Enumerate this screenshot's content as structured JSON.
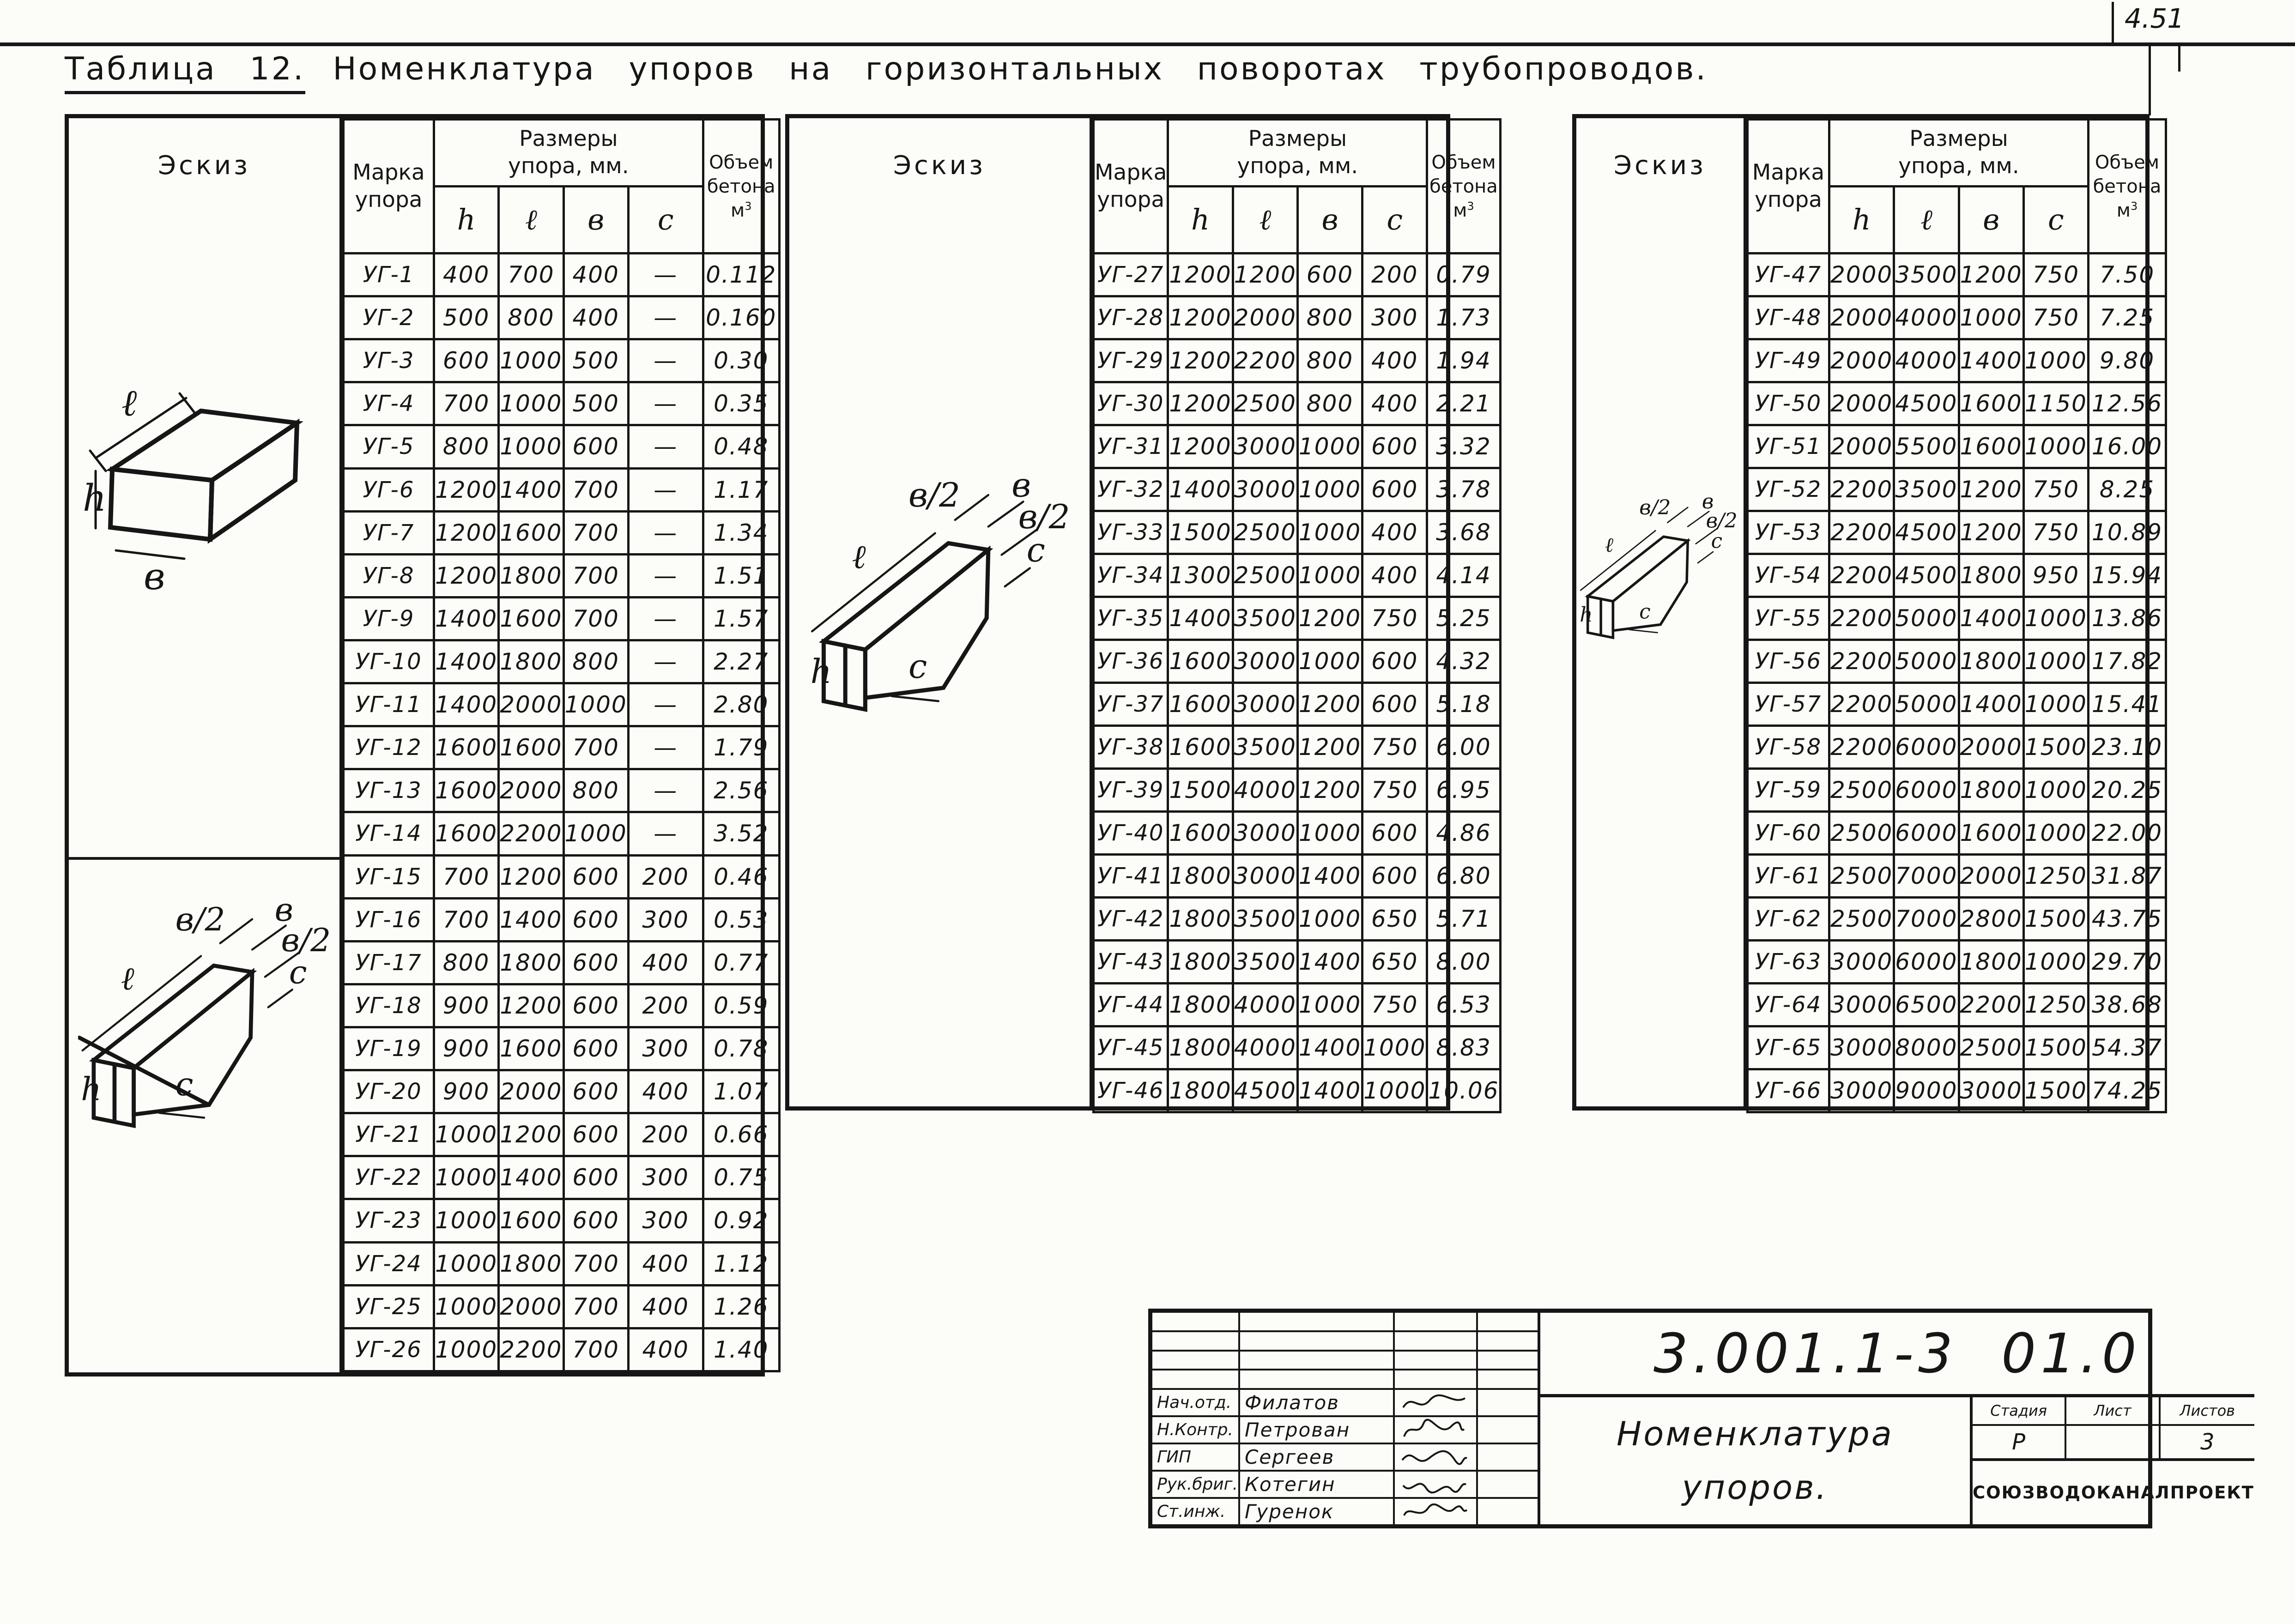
{
  "page": {
    "corner_mark": "4.51"
  },
  "title": {
    "label": "Таблица 12.",
    "text": "Номенклатура  упоров  на  горизонтальных  поворотах  трубопроводов."
  },
  "headers": {
    "sketch": "Эскиз",
    "mark_line1": "Марка",
    "mark_line2": "упора",
    "sizes_line1": "Размеры",
    "sizes_line2": "упора,  мм.",
    "h": "h",
    "l": "ℓ",
    "b": "в",
    "c": "с",
    "volume_line1": "Объем",
    "volume_line2": "бетона",
    "volume_m": "м",
    "volume_sup": "3"
  },
  "sketch_labels": {
    "l": "ℓ",
    "b": "в",
    "h": "h",
    "b_half": "в/2",
    "c": "с"
  },
  "tables": [
    {
      "rows": [
        [
          "УГ-1",
          "400",
          "700",
          "400",
          "—",
          "0.112"
        ],
        [
          "УГ-2",
          "500",
          "800",
          "400",
          "—",
          "0.160"
        ],
        [
          "УГ-3",
          "600",
          "1000",
          "500",
          "—",
          "0.30"
        ],
        [
          "УГ-4",
          "700",
          "1000",
          "500",
          "—",
          "0.35"
        ],
        [
          "УГ-5",
          "800",
          "1000",
          "600",
          "—",
          "0.48"
        ],
        [
          "УГ-6",
          "1200",
          "1400",
          "700",
          "—",
          "1.17"
        ],
        [
          "УГ-7",
          "1200",
          "1600",
          "700",
          "—",
          "1.34"
        ],
        [
          "УГ-8",
          "1200",
          "1800",
          "700",
          "—",
          "1.51"
        ],
        [
          "УГ-9",
          "1400",
          "1600",
          "700",
          "—",
          "1.57"
        ],
        [
          "УГ-10",
          "1400",
          "1800",
          "800",
          "—",
          "2.27"
        ],
        [
          "УГ-11",
          "1400",
          "2000",
          "1000",
          "—",
          "2.80"
        ],
        [
          "УГ-12",
          "1600",
          "1600",
          "700",
          "—",
          "1.79"
        ],
        [
          "УГ-13",
          "1600",
          "2000",
          "800",
          "—",
          "2.56"
        ],
        [
          "УГ-14",
          "1600",
          "2200",
          "1000",
          "—",
          "3.52"
        ],
        [
          "УГ-15",
          "700",
          "1200",
          "600",
          "200",
          "0.46"
        ],
        [
          "УГ-16",
          "700",
          "1400",
          "600",
          "300",
          "0.53"
        ],
        [
          "УГ-17",
          "800",
          "1800",
          "600",
          "400",
          "0.77"
        ],
        [
          "УГ-18",
          "900",
          "1200",
          "600",
          "200",
          "0.59"
        ],
        [
          "УГ-19",
          "900",
          "1600",
          "600",
          "300",
          "0.78"
        ],
        [
          "УГ-20",
          "900",
          "2000",
          "600",
          "400",
          "1.07"
        ],
        [
          "УГ-21",
          "1000",
          "1200",
          "600",
          "200",
          "0.66"
        ],
        [
          "УГ-22",
          "1000",
          "1400",
          "600",
          "300",
          "0.75"
        ],
        [
          "УГ-23",
          "1000",
          "1600",
          "600",
          "300",
          "0.92"
        ],
        [
          "УГ-24",
          "1000",
          "1800",
          "700",
          "400",
          "1.12"
        ],
        [
          "УГ-25",
          "1000",
          "2000",
          "700",
          "400",
          "1.26"
        ],
        [
          "УГ-26",
          "1000",
          "2200",
          "700",
          "400",
          "1.40"
        ]
      ]
    },
    {
      "rows": [
        [
          "УГ-27",
          "1200",
          "1200",
          "600",
          "200",
          "0.79"
        ],
        [
          "УГ-28",
          "1200",
          "2000",
          "800",
          "300",
          "1.73"
        ],
        [
          "УГ-29",
          "1200",
          "2200",
          "800",
          "400",
          "1.94"
        ],
        [
          "УГ-30",
          "1200",
          "2500",
          "800",
          "400",
          "2.21"
        ],
        [
          "УГ-31",
          "1200",
          "3000",
          "1000",
          "600",
          "3.32"
        ],
        [
          "УГ-32",
          "1400",
          "3000",
          "1000",
          "600",
          "3.78"
        ],
        [
          "УГ-33",
          "1500",
          "2500",
          "1000",
          "400",
          "3.68"
        ],
        [
          "УГ-34",
          "1300",
          "2500",
          "1000",
          "400",
          "4.14"
        ],
        [
          "УГ-35",
          "1400",
          "3500",
          "1200",
          "750",
          "5.25"
        ],
        [
          "УГ-36",
          "1600",
          "3000",
          "1000",
          "600",
          "4.32"
        ],
        [
          "УГ-37",
          "1600",
          "3000",
          "1200",
          "600",
          "5.18"
        ],
        [
          "УГ-38",
          "1600",
          "3500",
          "1200",
          "750",
          "6.00"
        ],
        [
          "УГ-39",
          "1500",
          "4000",
          "1200",
          "750",
          "6.95"
        ],
        [
          "УГ-40",
          "1600",
          "3000",
          "1000",
          "600",
          "4.86"
        ],
        [
          "УГ-41",
          "1800",
          "3000",
          "1400",
          "600",
          "6.80"
        ],
        [
          "УГ-42",
          "1800",
          "3500",
          "1000",
          "650",
          "5.71"
        ],
        [
          "УГ-43",
          "1800",
          "3500",
          "1400",
          "650",
          "8.00"
        ],
        [
          "УГ-44",
          "1800",
          "4000",
          "1000",
          "750",
          "6.53"
        ],
        [
          "УГ-45",
          "1800",
          "4000",
          "1400",
          "1000",
          "8.83"
        ],
        [
          "УГ-46",
          "1800",
          "4500",
          "1400",
          "1000",
          "10.06"
        ]
      ]
    },
    {
      "rows": [
        [
          "УГ-47",
          "2000",
          "3500",
          "1200",
          "750",
          "7.50"
        ],
        [
          "УГ-48",
          "2000",
          "4000",
          "1000",
          "750",
          "7.25"
        ],
        [
          "УГ-49",
          "2000",
          "4000",
          "1400",
          "1000",
          "9.80"
        ],
        [
          "УГ-50",
          "2000",
          "4500",
          "1600",
          "1150",
          "12.56"
        ],
        [
          "УГ-51",
          "2000",
          "5500",
          "1600",
          "1000",
          "16.00"
        ],
        [
          "УГ-52",
          "2200",
          "3500",
          "1200",
          "750",
          "8.25"
        ],
        [
          "УГ-53",
          "2200",
          "4500",
          "1200",
          "750",
          "10.89"
        ],
        [
          "УГ-54",
          "2200",
          "4500",
          "1800",
          "950",
          "15.94"
        ],
        [
          "УГ-55",
          "2200",
          "5000",
          "1400",
          "1000",
          "13.86"
        ],
        [
          "УГ-56",
          "2200",
          "5000",
          "1800",
          "1000",
          "17.82"
        ],
        [
          "УГ-57",
          "2200",
          "5000",
          "1400",
          "1000",
          "15.41"
        ],
        [
          "УГ-58",
          "2200",
          "6000",
          "2000",
          "1500",
          "23.10"
        ],
        [
          "УГ-59",
          "2500",
          "6000",
          "1800",
          "1000",
          "20.25"
        ],
        [
          "УГ-60",
          "2500",
          "6000",
          "1600",
          "1000",
          "22.00"
        ],
        [
          "УГ-61",
          "2500",
          "7000",
          "2000",
          "1250",
          "31.87"
        ],
        [
          "УГ-62",
          "2500",
          "7000",
          "2800",
          "1500",
          "43.75"
        ],
        [
          "УГ-63",
          "3000",
          "6000",
          "1800",
          "1000",
          "29.70"
        ],
        [
          "УГ-64",
          "3000",
          "6500",
          "2200",
          "1250",
          "38.68"
        ],
        [
          "УГ-65",
          "3000",
          "8000",
          "2500",
          "1500",
          "54.37"
        ],
        [
          "УГ-66",
          "3000",
          "9000",
          "3000",
          "1500",
          "74.25"
        ]
      ]
    }
  ],
  "title_block": {
    "doc_number": "3.001.1-3  01.0",
    "doc_title_line1": "Номенклатура",
    "doc_title_line2": "упоров.",
    "stage_header": "Стадия",
    "sheet_header": "Лист",
    "sheets_header": "Листов",
    "stage_value": "Р",
    "sheet_value": "",
    "sheets_value": "3",
    "organization": "СОЮЗВОДОКАНАЛПРОЕКТ",
    "signatures": [
      {
        "role": "Нач.отд.",
        "name": "Филатов"
      },
      {
        "role": "Н.Контр.",
        "name": "Петрован"
      },
      {
        "role": "ГИП",
        "name": "Сергеев"
      },
      {
        "role": "Рук.бриг.",
        "name": "Котегин"
      },
      {
        "role": "Ст.инж.",
        "name": "Гуренок"
      }
    ]
  }
}
